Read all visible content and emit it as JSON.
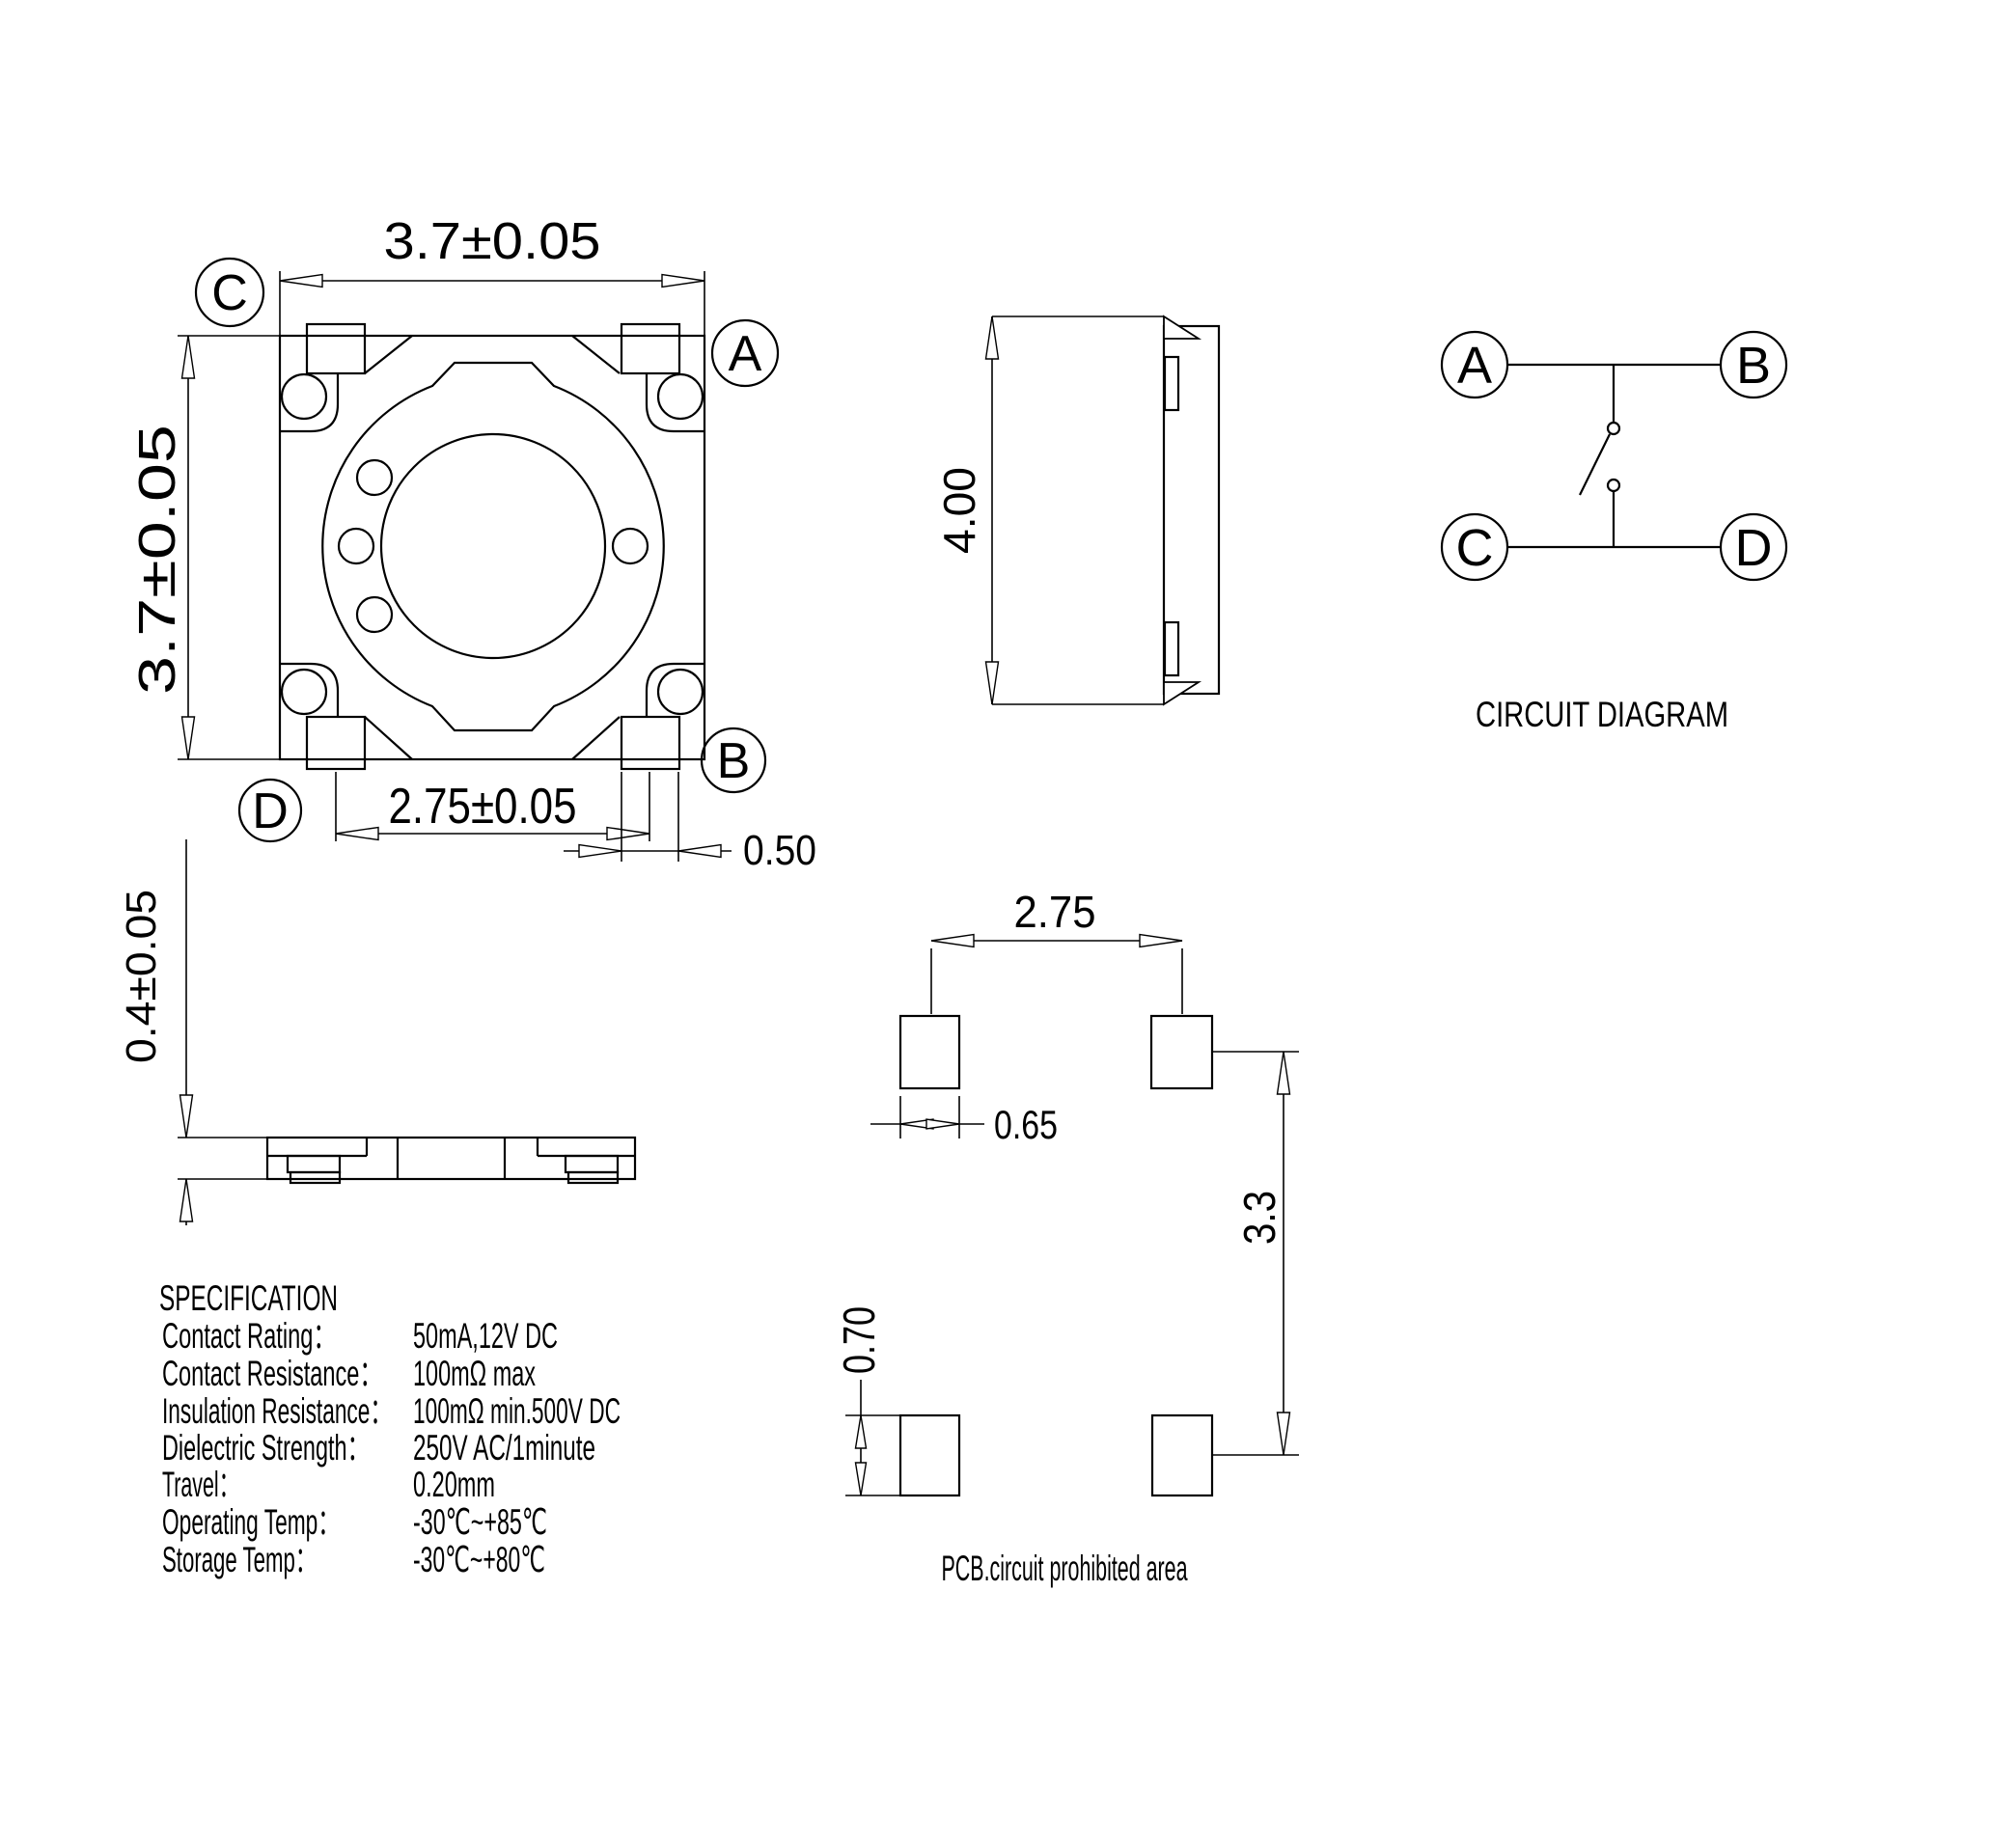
{
  "views": {
    "top": {
      "dim_width": "3.7±0.05",
      "dim_height": "3.7±0.05",
      "dim_pitch": "2.75±0.05",
      "dim_pad": "0.50",
      "corner_labels": {
        "top_left": "C",
        "top_right": "A",
        "bottom_left": "D",
        "bottom_right": "B"
      }
    },
    "side": {
      "dim_height": "4.00"
    },
    "profile": {
      "dim_thickness": "0.4±0.05"
    },
    "circuit": {
      "title": "CIRCUIT DIAGRAM",
      "terminals": {
        "a": "A",
        "b": "B",
        "c": "C",
        "d": "D"
      }
    },
    "pcb": {
      "caption": "PCB.circuit prohibited area",
      "dim_pitch_x": "2.75",
      "dim_pad_width": "0.65",
      "dim_pitch_y": "3.3",
      "dim_pad_height": "0.70"
    }
  },
  "specification": {
    "title": "SPECIFICATION",
    "rows": [
      {
        "label": "Contact Rating：",
        "value": "50mA,12V DC"
      },
      {
        "label": "Contact Resistance：",
        "value": "100mΩ max"
      },
      {
        "label": "Insulation Resistance：",
        "value": "100mΩ min.500V DC"
      },
      {
        "label": "Dielectric Strength：",
        "value": "250V AC/1minute"
      },
      {
        "label": "Travel：",
        "value": "0.20mm"
      },
      {
        "label": "Operating Temp：",
        "value": "-30℃~+85℃"
      },
      {
        "label": "Storage Temp：",
        "value": "-30℃~+80℃"
      }
    ]
  },
  "colors": {
    "line": "#000000",
    "background": "#ffffff",
    "text": "#000000"
  }
}
